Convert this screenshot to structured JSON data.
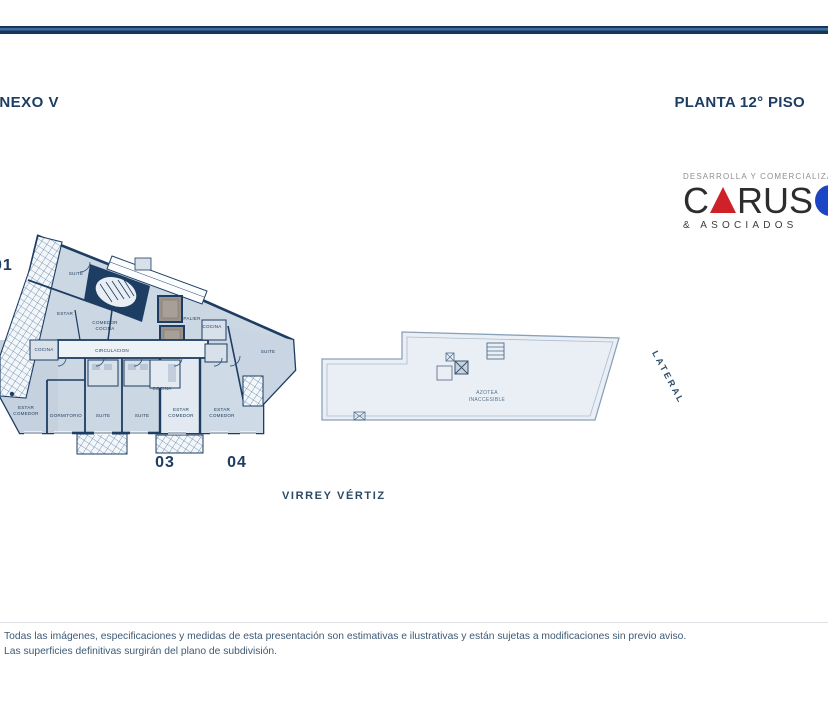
{
  "header": {
    "annex_label": "ANEXO V",
    "title": "PLANTA 12° PISO"
  },
  "logo": {
    "tagline": "DESARROLLA Y COMERCIALIZA",
    "name_part1": "C",
    "name_part2": "RUS",
    "subtitle": "& ASOCIADOS",
    "colors": {
      "triangle_red": "#cf2127",
      "circle_blue": "#1b45c4",
      "letters": "#2d2d2d"
    }
  },
  "plan": {
    "unit_numbers": {
      "left": "01",
      "unit3": "03",
      "unit4": "04"
    },
    "labels": {
      "suite_top": "SUITE",
      "estar_top": "ESTAR",
      "comedor_cocina": [
        "COMEDOR",
        "COCINA"
      ],
      "cocina_left": "COCINA",
      "circulacion": "CIRCULACION",
      "palier": "PALIER",
      "cocina_mid": "COCINA",
      "suite_right": "SUITE",
      "estar_comedor_left": [
        "ESTAR",
        "COMEDOR"
      ],
      "dormitorio": "DORMITORIO",
      "suite_a": "SUITE",
      "suite_b": "SUITE",
      "cocina_center": "COCINA",
      "estar_comedor_center": [
        "ESTAR",
        "COMEDOR"
      ],
      "estar_comedor_right": [
        "ESTAR",
        "COMEDOR"
      ]
    },
    "colors": {
      "wall_navy": "#1d3d62",
      "room_fill": "#ccd7e4",
      "hatch_line": "#5f80a4"
    }
  },
  "azotea": {
    "label": [
      "AZOTEA",
      "INACCESIBLE"
    ]
  },
  "annotations": {
    "lateral": "LATERAL",
    "street": "VIRREY VÉRTIZ"
  },
  "footer": {
    "line1": "Todas las imágenes, especificaciones y medidas de esta presentación son estimativas e ilustrativas y están sujetas a modificaciones sin previo aviso.",
    "line2": "Las superficies definitivas surgirán del plano de subdivisión."
  }
}
